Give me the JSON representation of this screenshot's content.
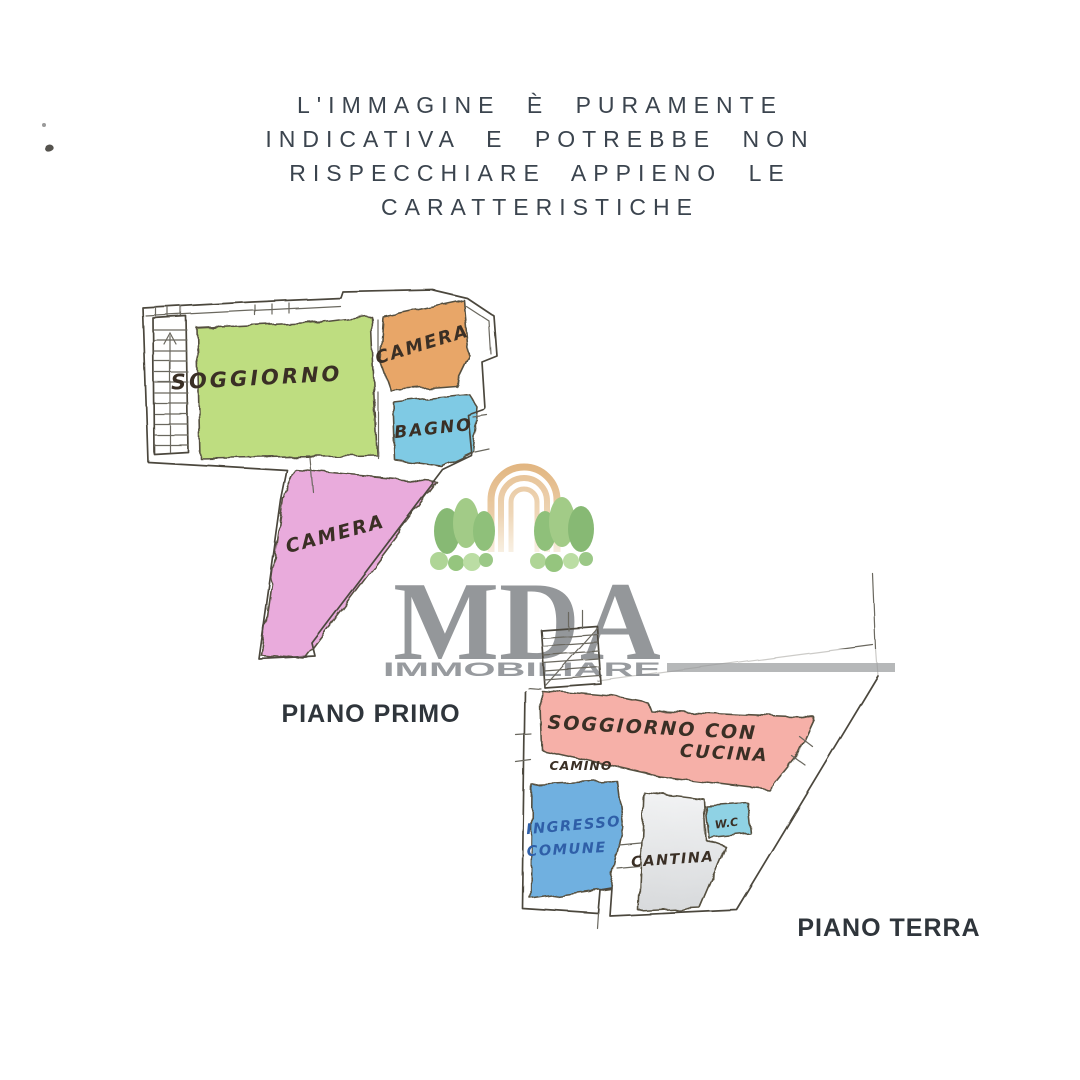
{
  "disclaimer": {
    "lines": [
      "L'IMMAGINE È PURAMENTE",
      "INDICATIVA E POTREBBE NON",
      "RISPECCHIARE APPIENO LE",
      "CARATTERISTICHE"
    ]
  },
  "watermark": {
    "brand": "MDA",
    "subtitle": "IMMOBILIARE",
    "brand_color": "#8b8e91",
    "arch_color": "#e2bb8d",
    "tree_color": "#7db368"
  },
  "floor_first": {
    "label": "PIANO PRIMO",
    "rooms": {
      "soggiorno": {
        "label": "SOGGIORNO",
        "color": "#bedd80"
      },
      "camera_top": {
        "label": "CAMERA",
        "color": "#e8a668"
      },
      "bagno": {
        "label": "BAGNO",
        "color": "#7fcae4"
      },
      "camera_bottom": {
        "label": "CAMERA",
        "color": "#e9abdc"
      }
    }
  },
  "floor_ground": {
    "label": "PIANO TERRA",
    "rooms": {
      "soggiorno_cucina": {
        "label_line1": "SOGGIORNO CON",
        "label_line2": "CUCINA",
        "color": "#f6b0a8"
      },
      "camino": {
        "label": "CAMINO"
      },
      "ingresso": {
        "label_line1": "INGRESSO",
        "label_line2": "COMUNE",
        "color": "#6fb0e0"
      },
      "cantina": {
        "label": "CANTINA",
        "color": "#dfe1e3"
      },
      "wc": {
        "label": "W.C",
        "color": "#8fd2e4"
      }
    }
  },
  "colors": {
    "ink": "#4b473e",
    "disclaimer_text": "#3b444e",
    "floor_label_text": "#2f353b"
  }
}
